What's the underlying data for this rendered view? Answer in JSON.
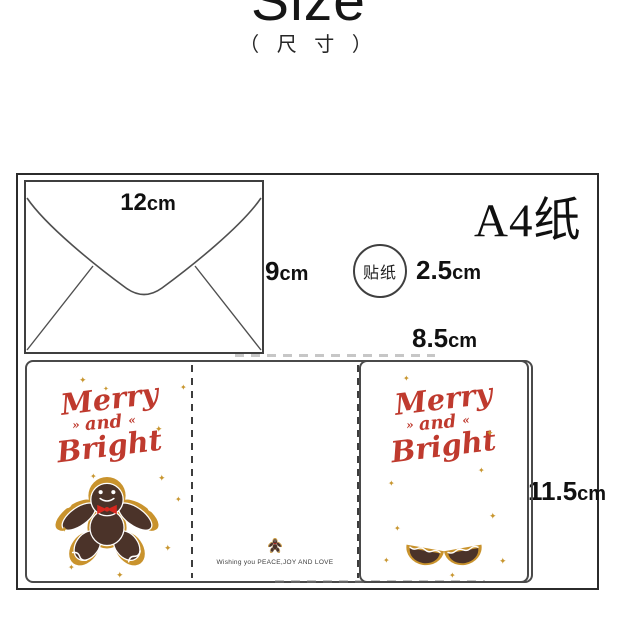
{
  "header": {
    "title": "Size",
    "subtitle": "（ 尺 寸 ）"
  },
  "a4": {
    "label": "A4纸"
  },
  "envelope": {
    "width": {
      "value": "12",
      "unit": "cm"
    },
    "height": {
      "value": "9",
      "unit": "cm"
    }
  },
  "sticker": {
    "label": "贴纸",
    "size": {
      "value": "2.5",
      "unit": "cm"
    }
  },
  "card": {
    "width": {
      "value": "8.5",
      "unit": "cm"
    },
    "height": {
      "value": "11.5",
      "unit": "cm"
    },
    "title_line1": "Merry",
    "title_line2": "and",
    "title_line3": "Bright",
    "message": "Wishing you PEACE,JOY AND LOVE"
  },
  "icons": {
    "star": "✦",
    "flourish_left": "»",
    "flourish_right": "«"
  },
  "colors": {
    "accent_red": "#bf3a2e",
    "gold": "#c8962f",
    "cookie_brown": "#4b3329",
    "outline": "#2b2b2b"
  }
}
